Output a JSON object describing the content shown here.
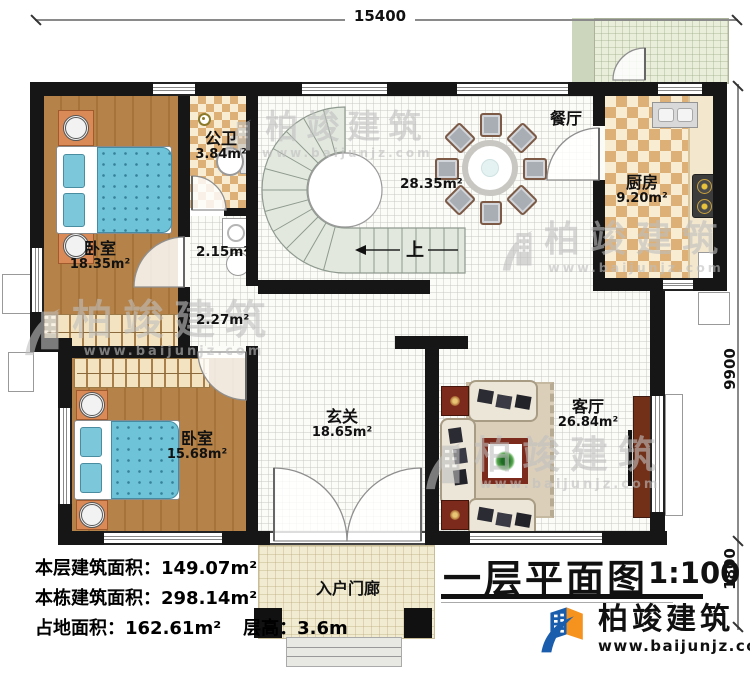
{
  "plan": {
    "title": "一层平面图",
    "scale": "1:100",
    "dims": {
      "width": "15400",
      "height_main": "9900",
      "height_porch": "1800"
    },
    "rooms": {
      "bedroom1": {
        "name": "卧室",
        "area": "18.35m²"
      },
      "bathroom": {
        "name": "公卫",
        "area": "3.84m²"
      },
      "laundry": {
        "area": "2.15m²"
      },
      "corridor": {
        "area": "2.27m²"
      },
      "dining": {
        "name": "餐厅",
        "area": "28.35m²"
      },
      "kitchen": {
        "name": "厨房",
        "area": "9.20m²"
      },
      "bedroom2": {
        "name": "卧室",
        "area": "15.68m²"
      },
      "foyer": {
        "name": "玄关",
        "area": "18.65m²"
      },
      "living": {
        "name": "客厅",
        "area": "26.84m²"
      },
      "porch": {
        "name": "入户门廊"
      }
    },
    "stair_up": "上",
    "stats": {
      "line1_label": "本层建筑面积：",
      "line1_value": "149.07m²",
      "line2_label": "本栋建筑面积：",
      "line2_value": "298.14m²",
      "line3_label": "占地面积：",
      "line3_value": "162.61m²",
      "line4_label": "层高：",
      "line4_value": "3.6m"
    }
  },
  "brand": {
    "name": "柏竣建筑",
    "website": "www.baijunjz.com"
  },
  "watermark": {
    "name": "柏竣建筑",
    "website": "www.baijunjz.com"
  },
  "colors": {
    "wall": "#161616",
    "wood": "#b5834a",
    "bed_blue": "#6fc3d8",
    "tile": "#ddb078",
    "stair": "#e2e8de",
    "logo_blue": "#1a5dac",
    "logo_orange": "#f6921e",
    "accent_red": "#7c2a1b"
  }
}
